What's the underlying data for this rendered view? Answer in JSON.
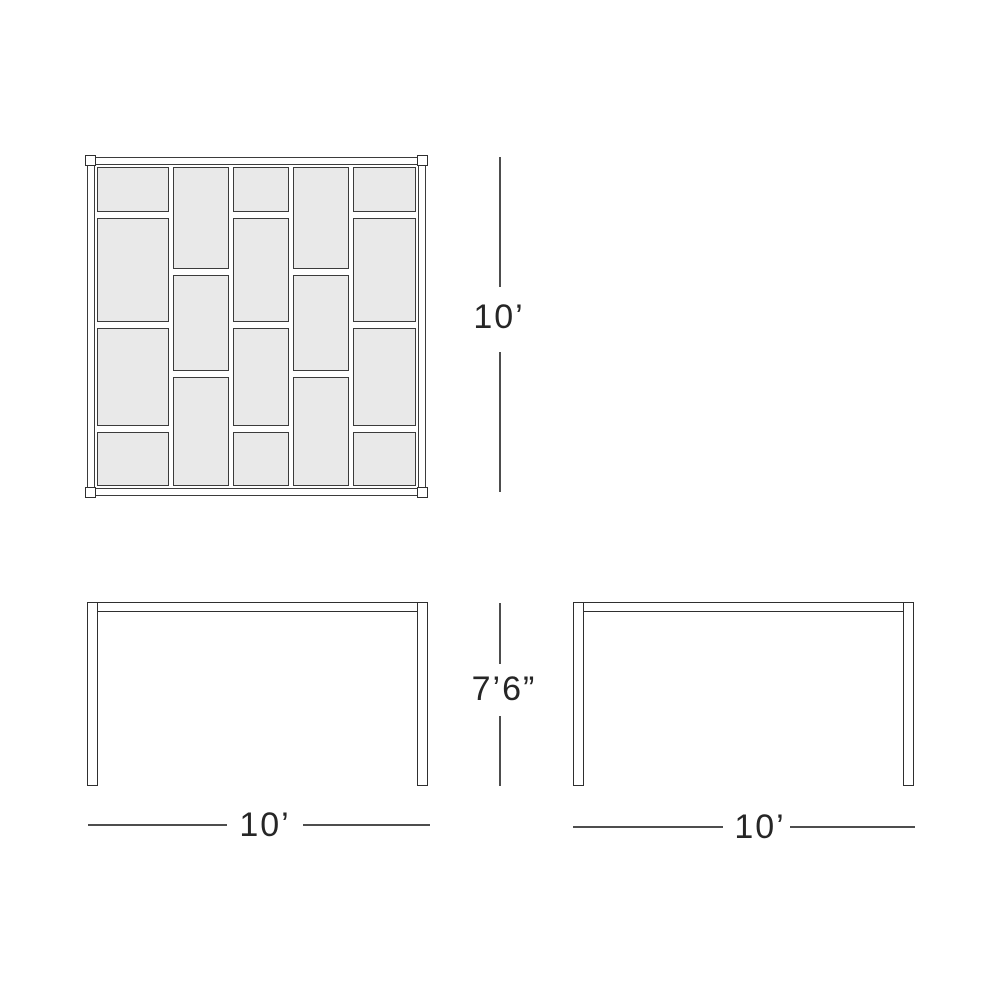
{
  "colors": {
    "background": "#ffffff",
    "line": "#3b3b3b",
    "line_strong": "#2f2f2f",
    "plank_fill": "#e9e9e9",
    "dim_line": "#4d4d4d",
    "text": "#262626"
  },
  "plan_view": {
    "pattern": {
      "column_widths": [
        70,
        55,
        55,
        54,
        62
      ],
      "columns": [
        {
          "segments": [
            43,
            102,
            95,
            52
          ]
        },
        {
          "segments": [
            100,
            93,
            107
          ]
        },
        {
          "segments": [
            43,
            102,
            95,
            52
          ]
        },
        {
          "segments": [
            100,
            93,
            107
          ]
        },
        {
          "segments": [
            43,
            102,
            95,
            52
          ]
        }
      ]
    }
  },
  "dimensions": {
    "plan_height": {
      "label": "10’"
    },
    "elevation_height": {
      "label": "7’6”"
    },
    "front_width": {
      "label": "10’"
    },
    "side_width": {
      "label": "10’"
    }
  }
}
